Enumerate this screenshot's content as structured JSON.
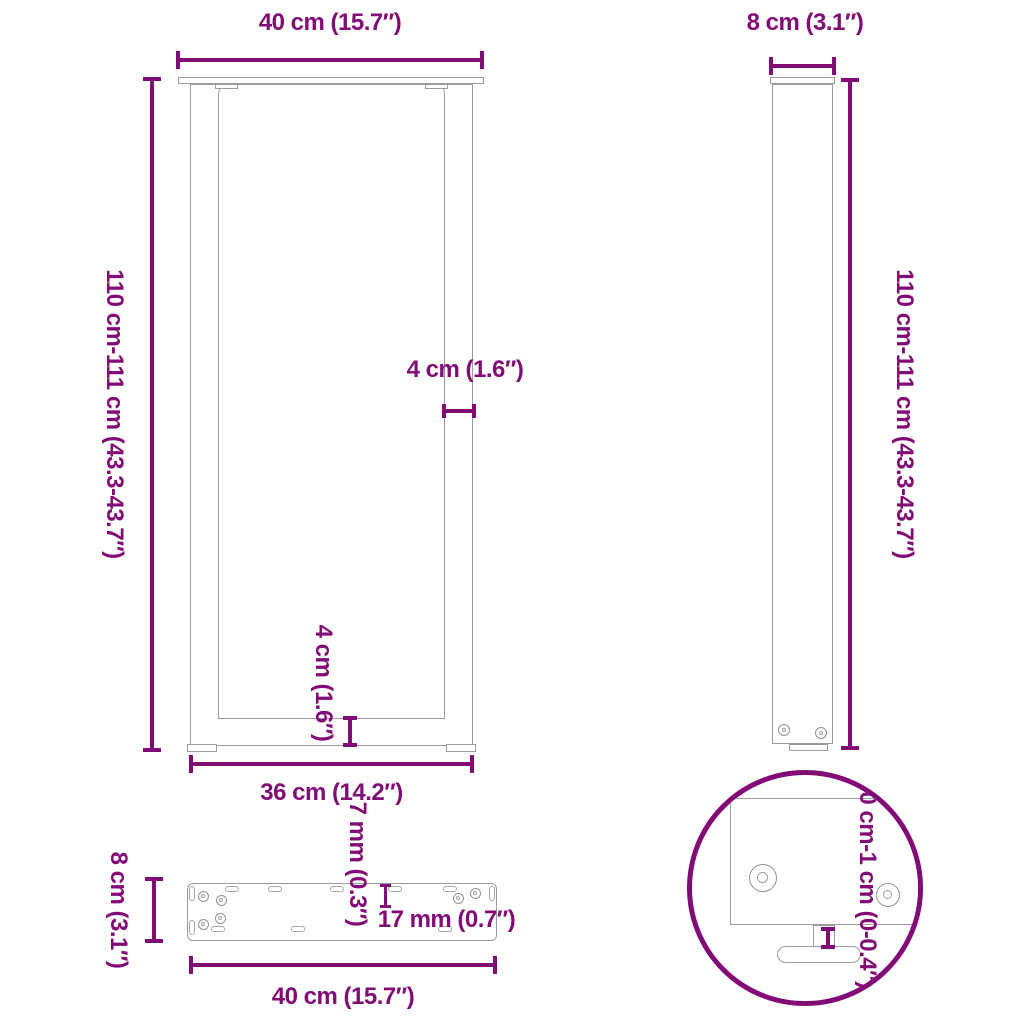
{
  "colors": {
    "dimension": "#820C76",
    "outline": "#9C9C9C",
    "background": "#FFFFFF"
  },
  "views": {
    "front": {
      "width_label": "40 cm (15.7″)",
      "height_label": "110 cm-111 cm (43.3-43.7″)",
      "leg_thickness_label": "4 cm (1.6″)",
      "crossbar_thickness_label": "4 cm (1.6″)",
      "inner_width_label": "36 cm (14.2″)"
    },
    "side": {
      "depth_label": "8 cm (3.1″)",
      "height_label": "110 cm-111 cm (43.3-43.7″)"
    },
    "top": {
      "depth_label": "8 cm (3.1″)",
      "slot_offset_label": "7 mm (0.3″)",
      "slot_length_label": "17 mm (0.7″)",
      "width_label": "40 cm (15.7″)"
    },
    "detail": {
      "adjustable_height_label": "0 cm-1 cm (0-0.4″)"
    }
  }
}
